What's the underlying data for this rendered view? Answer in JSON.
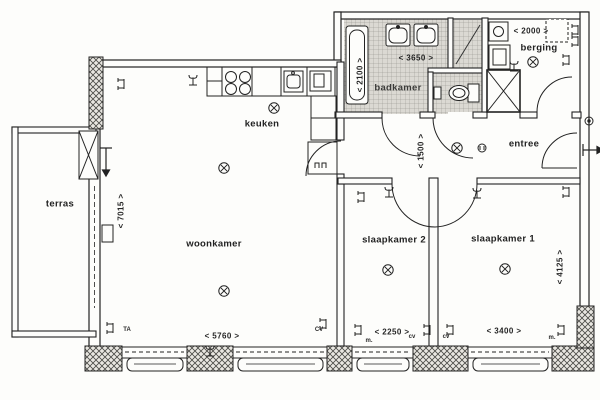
{
  "drawing": {
    "type": "floor-plan",
    "language": "nl",
    "description": "Scanned apartment floor plan with terrace, living room, kitchen, bathroom, storage, entrance hall and two bedrooms"
  },
  "colors": {
    "paper": "#fdfdfb",
    "ink": "#222222",
    "wall_hatch": "#4a4a46",
    "tile_floor": "#d9d7d1"
  },
  "rooms": [
    {
      "id": "terras",
      "label": "terras"
    },
    {
      "id": "woonkamer",
      "label": "woonkamer"
    },
    {
      "id": "keuken",
      "label": "keuken"
    },
    {
      "id": "badkamer",
      "label": "badkamer"
    },
    {
      "id": "berging",
      "label": "berging"
    },
    {
      "id": "entree",
      "label": "entree"
    },
    {
      "id": "slaapkamer2",
      "label": "slaapkamer 2"
    },
    {
      "id": "slaapkamer1",
      "label": "slaapkamer 1"
    }
  ],
  "dimensions": [
    {
      "id": "dim-3650",
      "text": "< 3650 >",
      "orientation": "horizontal",
      "area": "badkamer width"
    },
    {
      "id": "dim-2000",
      "text": "< 2000 >",
      "orientation": "horizontal",
      "area": "berging width"
    },
    {
      "id": "dim-2100",
      "text": "< 2100 >",
      "orientation": "vertical",
      "area": "badkamer depth"
    },
    {
      "id": "dim-1500",
      "text": "< 1500 >",
      "orientation": "vertical",
      "area": "hall width"
    },
    {
      "id": "dim-7015",
      "text": "< 7015 >",
      "orientation": "vertical",
      "area": "woonkamer depth"
    },
    {
      "id": "dim-5760",
      "text": "< 5760 >",
      "orientation": "horizontal",
      "area": "woonkamer width"
    },
    {
      "id": "dim-2250",
      "text": "< 2250 >",
      "orientation": "horizontal",
      "area": "slaapkamer 2 width"
    },
    {
      "id": "dim-3400",
      "text": "< 3400 >",
      "orientation": "horizontal",
      "area": "slaapkamer 1 width"
    },
    {
      "id": "dim-4125",
      "text": "< 4125 >",
      "orientation": "vertical",
      "area": "slaapkamer 1 depth"
    }
  ],
  "annotations": [
    {
      "id": "ta",
      "text": "TA"
    },
    {
      "id": "cv-caps",
      "text": "CV"
    },
    {
      "id": "m-1",
      "text": "m."
    },
    {
      "id": "cv-1",
      "text": "cv"
    },
    {
      "id": "cv-2",
      "text": "cv"
    },
    {
      "id": "m-2",
      "text": "m."
    }
  ],
  "icons": {
    "ceiling-light-icon": "circle with X cross",
    "pull-switch-icon": "small circle with bars",
    "wall-socket-icon": "double bracket on wall",
    "switch-icon": "trident fork symbol",
    "duct-icon": "square with X diagonals",
    "doorbell-icon": "small circle with dot",
    "exit-arrow-icon": "arrow through front door",
    "terrace-door-arrow-icon": "downward swing arrow"
  }
}
